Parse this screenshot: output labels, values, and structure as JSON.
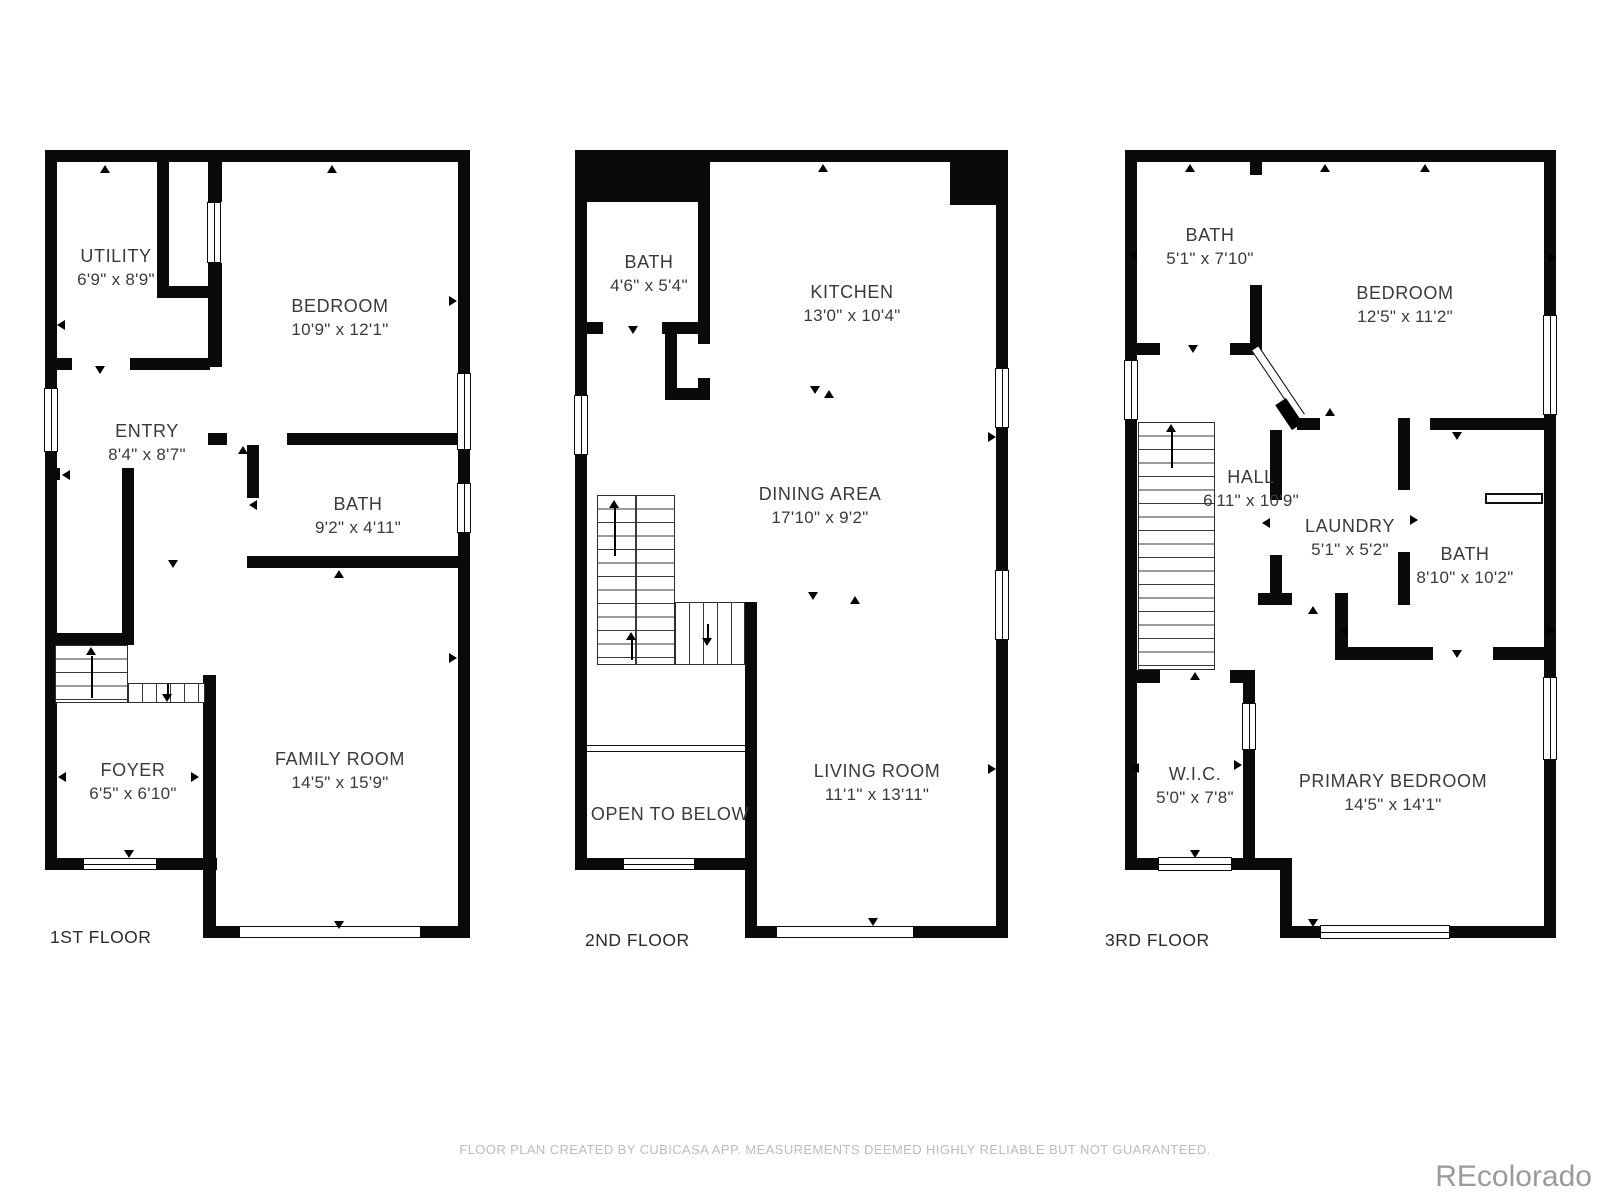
{
  "floors": [
    {
      "label": "1ST FLOOR",
      "rooms": [
        {
          "name": "UTILITY",
          "dims": "6'9\" x 8'9\""
        },
        {
          "name": "BEDROOM",
          "dims": "10'9\" x 12'1\""
        },
        {
          "name": "ENTRY",
          "dims": "8'4\" x 8'7\""
        },
        {
          "name": "BATH",
          "dims": "9'2\" x 4'11\""
        },
        {
          "name": "FOYER",
          "dims": "6'5\" x 6'10\""
        },
        {
          "name": "FAMILY ROOM",
          "dims": "14'5\" x 15'9\""
        }
      ]
    },
    {
      "label": "2ND FLOOR",
      "rooms": [
        {
          "name": "BATH",
          "dims": "4'6\" x 5'4\""
        },
        {
          "name": "KITCHEN",
          "dims": "13'0\" x 10'4\""
        },
        {
          "name": "DINING AREA",
          "dims": "17'10\" x 9'2\""
        },
        {
          "name": "LIVING ROOM",
          "dims": "11'1\" x 13'11\""
        },
        {
          "name": "OPEN TO BELOW",
          "dims": ""
        }
      ]
    },
    {
      "label": "3RD FLOOR",
      "rooms": [
        {
          "name": "BATH",
          "dims": "5'1\" x 7'10\""
        },
        {
          "name": "BEDROOM",
          "dims": "12'5\" x 11'2\""
        },
        {
          "name": "HALL",
          "dims": "6'11\" x 10'9\""
        },
        {
          "name": "LAUNDRY",
          "dims": "5'1\" x 5'2\""
        },
        {
          "name": "BATH",
          "dims": "8'10\" x 10'2\""
        },
        {
          "name": "W.I.C.",
          "dims": "5'0\" x 7'8\""
        },
        {
          "name": "PRIMARY BEDROOM",
          "dims": "14'5\" x 14'1\""
        }
      ]
    }
  ],
  "footer": "FLOOR PLAN CREATED BY CUBICASA APP. MEASUREMENTS DEEMED HIGHLY RELIABLE BUT NOT GUARANTEED.",
  "watermark": "REcolorado",
  "colors": {
    "wall": "#0a0a0a",
    "text": "#3a3a3a",
    "footer": "#bcbcbc",
    "watermark": "#9b9b9b"
  }
}
